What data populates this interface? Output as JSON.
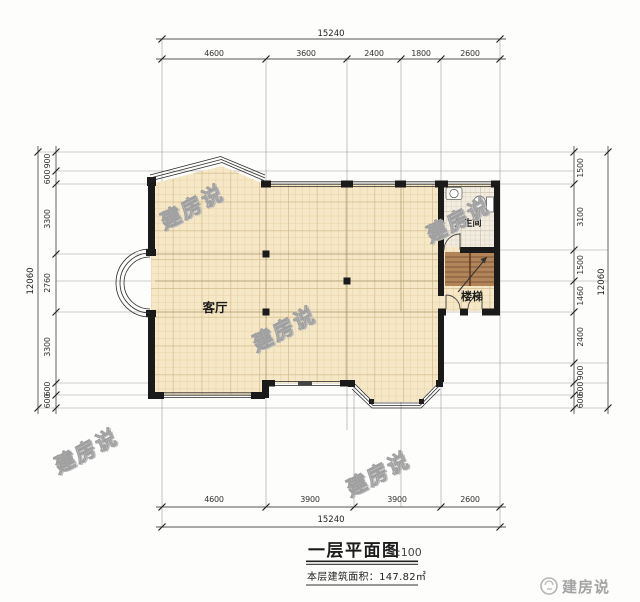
{
  "drawing": {
    "title": "一层平面图",
    "scale_label": "1:100",
    "area_note": "本层建筑面积：147.82㎡",
    "watermark_text": "建房说",
    "brand_name": "建房说",
    "rooms": {
      "living_room": "客厅",
      "stairs": "楼梯",
      "bathroom": "卫生间"
    },
    "colors": {
      "floor_tile": "#f6e8c6",
      "bath_tile": "#f2ede0",
      "stair_wood": "#b18459",
      "wall": "#1a1a1a",
      "dimension_text": "#333333"
    }
  },
  "dims": {
    "top": {
      "total": "15240",
      "segments": [
        "4600",
        "3600",
        "2400",
        "1800",
        "2600"
      ]
    },
    "bottom": {
      "total": "15240",
      "segments": [
        "4600",
        "3900",
        "3900",
        "2600"
      ]
    },
    "left": {
      "total": "12060",
      "segments": [
        "900",
        "600",
        "3300",
        "2760",
        "3300",
        "600",
        "600"
      ]
    },
    "right": {
      "total": "12060",
      "segments": [
        "1500",
        "3100",
        "1500",
        "1460",
        "2400",
        "900",
        "600",
        "600"
      ]
    }
  }
}
